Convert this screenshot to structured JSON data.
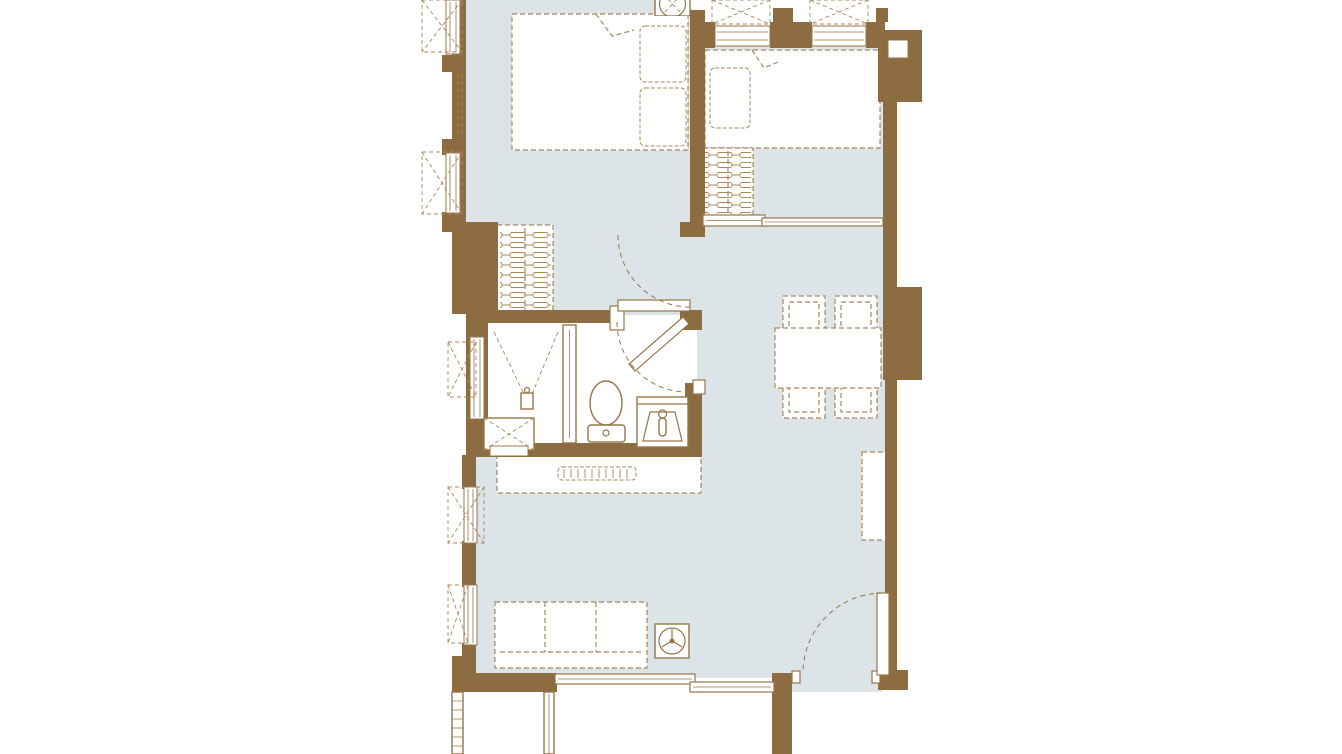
{
  "title": "apartment-floor-plan",
  "palette": {
    "wall": "#8d6c41",
    "floor": "#dce4e8",
    "line": "#97764a",
    "dash": "#a8895c",
    "bg": "#ffffff"
  },
  "inventory": {
    "rooms": [
      "bedroom-1",
      "bedroom-2",
      "bathroom",
      "living-dining-area",
      "balcony"
    ],
    "furniture": [
      "double-bed",
      "single-bed",
      "wardrobe-with-hangers",
      "wardrobe-with-hangers",
      "dining-table",
      "dining-chair",
      "dining-chair",
      "dining-chair",
      "dining-chair",
      "tv-console",
      "sofa-3-seat",
      "fan",
      "storage-cabinet"
    ],
    "fixtures": [
      "shower",
      "shower-glass-partition",
      "toilet",
      "vanity-sink"
    ],
    "doors": [
      "bedroom-1-swing-door",
      "bathroom-corner-swing-door",
      "bedroom-2-sliding-door",
      "balcony-sliding-door",
      "entry-swing-door"
    ],
    "counts": {
      "dining_chairs": 4,
      "windows": 7,
      "ac_condenser_units": 8,
      "sofa_seats": 3,
      "balcony_railing_rungs": 6
    }
  }
}
